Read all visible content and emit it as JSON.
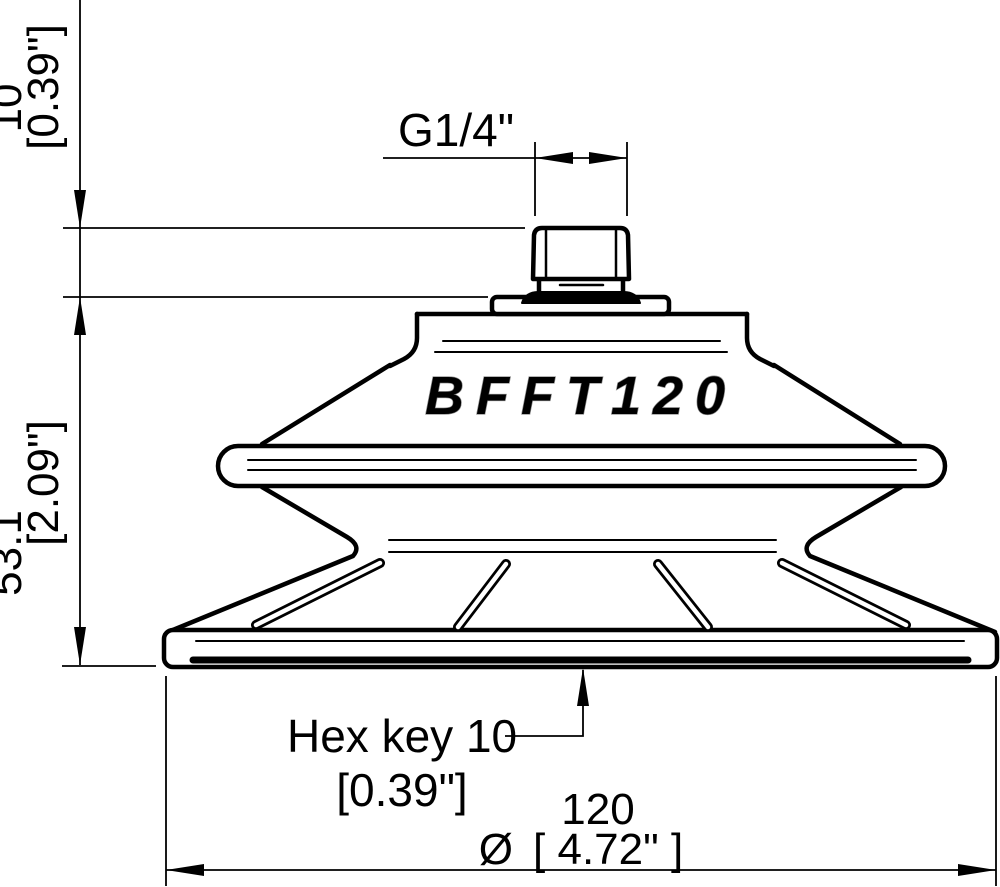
{
  "drawing": {
    "brand_model": "BFFT120",
    "thread_label": "G1/4\"",
    "dim_top_height": {
      "mm": "10",
      "inch": "[0.39\"]"
    },
    "dim_body_height": {
      "mm": "53.1",
      "inch": "[2.09\"]"
    },
    "dim_diameter": {
      "mm": "120",
      "symbol": "Ø",
      "inch": "[ 4.72\" ]"
    },
    "hex_key": {
      "line1": "Hex key 10",
      "line2": "[0.39\"]"
    },
    "colors": {
      "line": "#000000",
      "background": "#ffffff"
    }
  }
}
